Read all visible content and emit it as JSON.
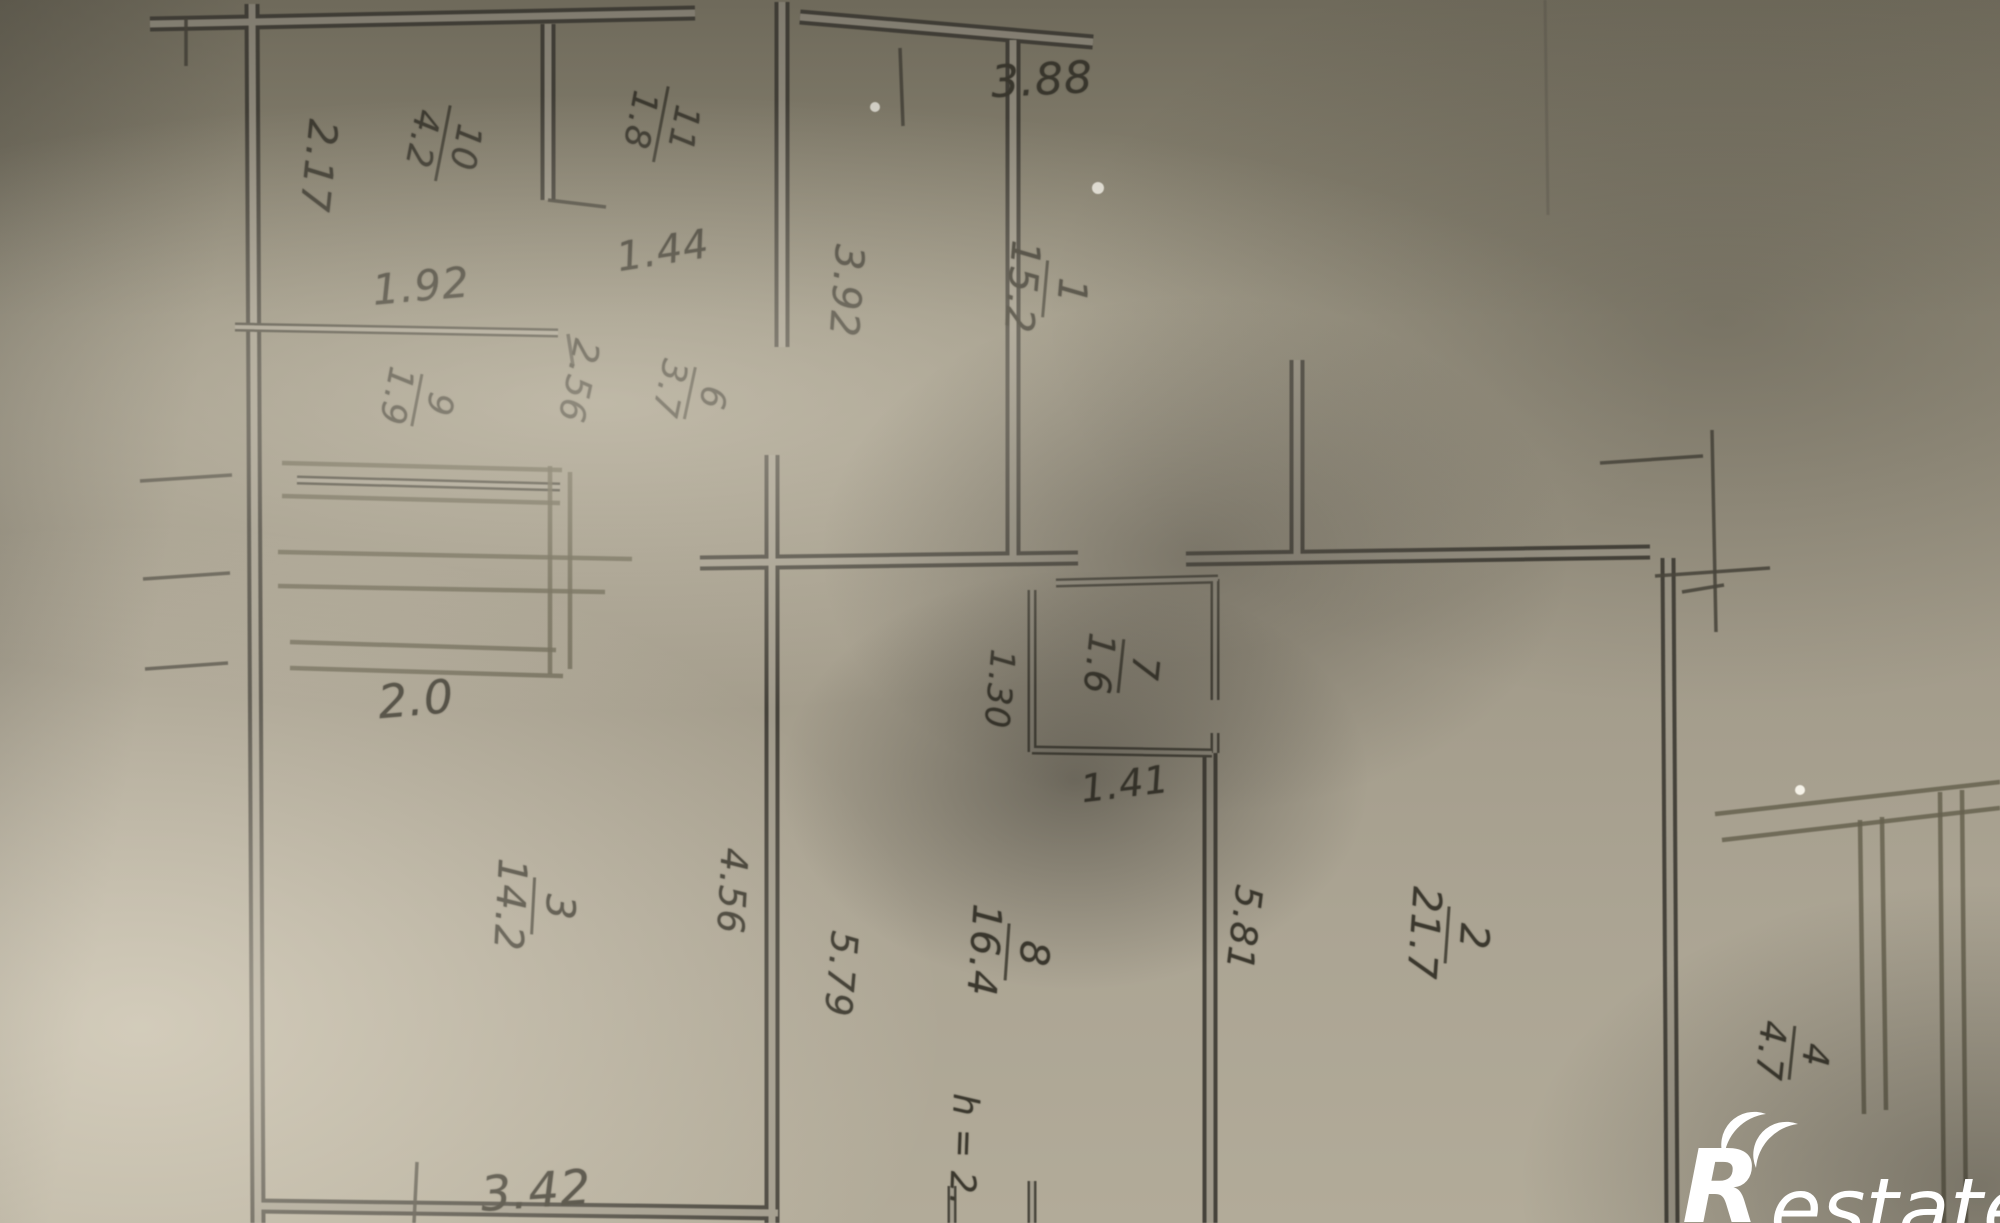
{
  "plan": {
    "rooms": [
      {
        "number": "1",
        "area": "15.2"
      },
      {
        "number": "2",
        "area": "21.7"
      },
      {
        "number": "3",
        "area": "14.2"
      },
      {
        "number": "4",
        "area": "4.7"
      },
      {
        "number": "6",
        "area": "3.7"
      },
      {
        "number": "7",
        "area": "1.6"
      },
      {
        "number": "8",
        "area": "16.4"
      },
      {
        "number": "9",
        "area": "1.9"
      },
      {
        "number": "10",
        "area": "4.2"
      },
      {
        "number": "11",
        "area": "1.8"
      }
    ],
    "dimensions": {
      "d388": "3.88",
      "d217": "2.17",
      "d192": "1.92",
      "d144": "1.44",
      "d392": "3.92",
      "d256": "2.56",
      "d20": "2.0",
      "d130": "1.30",
      "d141": "1.41",
      "d456": "4.56",
      "d579": "5.79",
      "d581": "5.81",
      "d342": "3.42",
      "height_note": "h = 2."
    }
  },
  "watermark": {
    "r": "R",
    "suffix": "estate",
    "color": "#ffffff"
  }
}
